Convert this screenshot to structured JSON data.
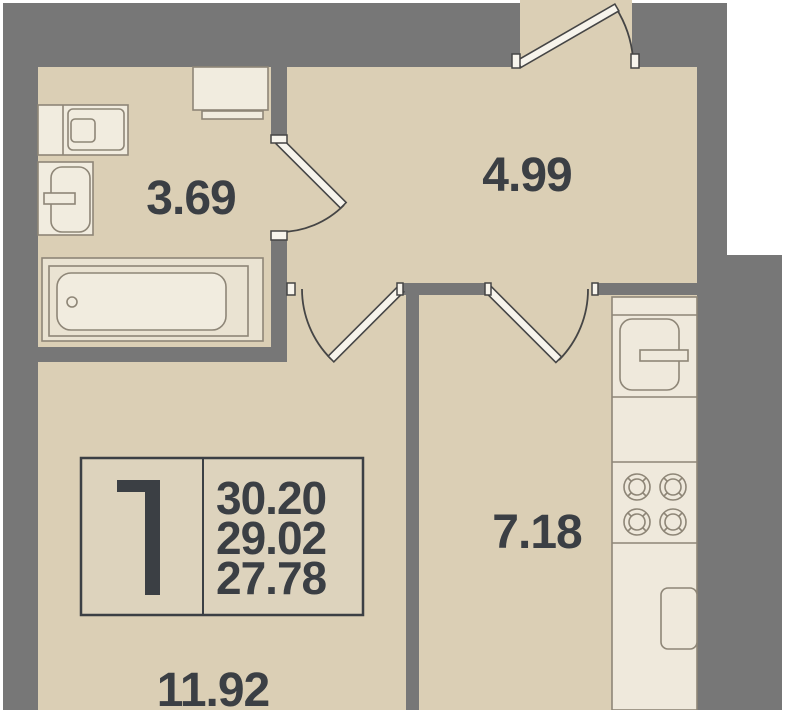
{
  "legend": {
    "room_count": "1",
    "area_total": "30.20",
    "area_reduced": "29.02",
    "area_living": "27.78"
  },
  "rooms": {
    "bathroom": {
      "area": "3.69"
    },
    "hallway": {
      "area": "4.99"
    },
    "kitchen": {
      "area": "7.18"
    },
    "living_room": {
      "area": "11.92"
    }
  },
  "fixtures": [
    "toilet-icon",
    "sink-icon",
    "washing-machine-icon",
    "bathtub-icon",
    "fridge-icon",
    "stove-burners-icon",
    "kitchen-sink-icon",
    "kitchen-counter",
    "door-swing-symbol"
  ],
  "colors": {
    "wall": "#777777",
    "floor": "#dbcfb5",
    "fixture_fill": "#f1ecdf",
    "counter_fill": "#efe9dc",
    "tub_deck": "#eae3d2",
    "legend_fill": "#ddd3bd",
    "furniture_stroke": "#8e8677",
    "text": "#3b3f44",
    "door_stroke": "#454545",
    "outside": "#ffffff"
  }
}
